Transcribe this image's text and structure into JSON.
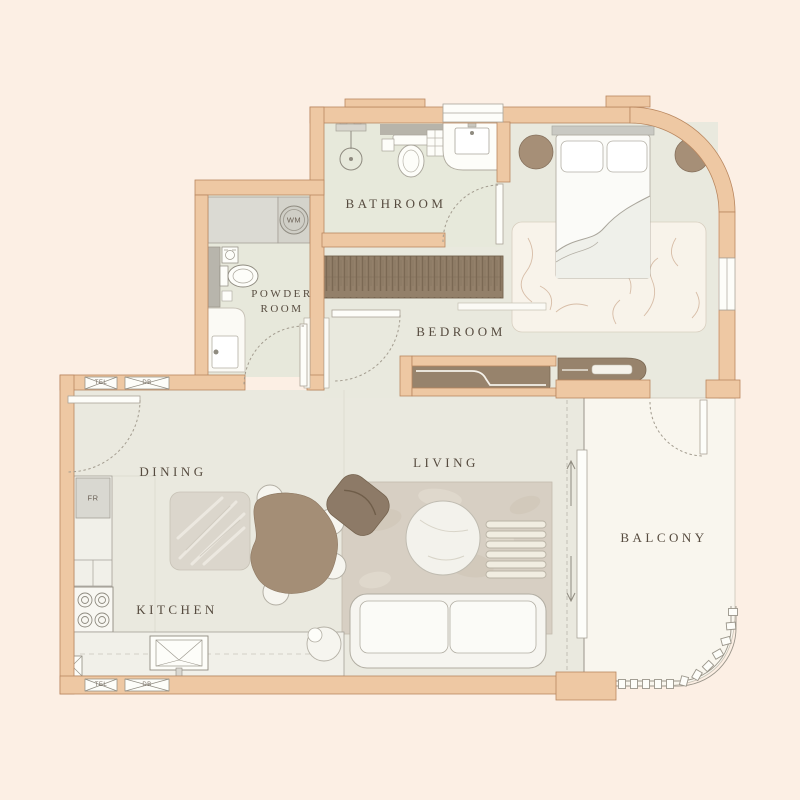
{
  "plan_title": "one-bedroom apartment floor plan",
  "rooms": {
    "bathroom": "BATHROOM",
    "powder_room": "POWDER ROOM",
    "bedroom": "BEDROOM",
    "dining": "DINING",
    "living": "LIVING",
    "kitchen": "KITCHEN",
    "balcony": "BALCONY"
  },
  "fixtures": {
    "washing_machine": "WM",
    "fridge": "FR"
  },
  "utilities": {
    "tel": "TEL",
    "db": "DB"
  },
  "palette": {
    "background": "#FCEFE4",
    "wall_fill": "#EEC8A3",
    "wall_outline": "#B9875F",
    "floor": "#EAE9DF",
    "bathroom_floor": "#E7E9DB",
    "balcony_floor": "#F9F6EE",
    "living_rug": "#D7CFC3",
    "dining_rug": "#DBD6CC",
    "bedroom_rug": "#F8F3EA",
    "furniture_brown": "#97836C",
    "furniture_white": "#F6F5F0",
    "counter_gray": "#DBDAD3",
    "wardrobe_brown": "#93806A",
    "label_text": "#564B3F"
  }
}
